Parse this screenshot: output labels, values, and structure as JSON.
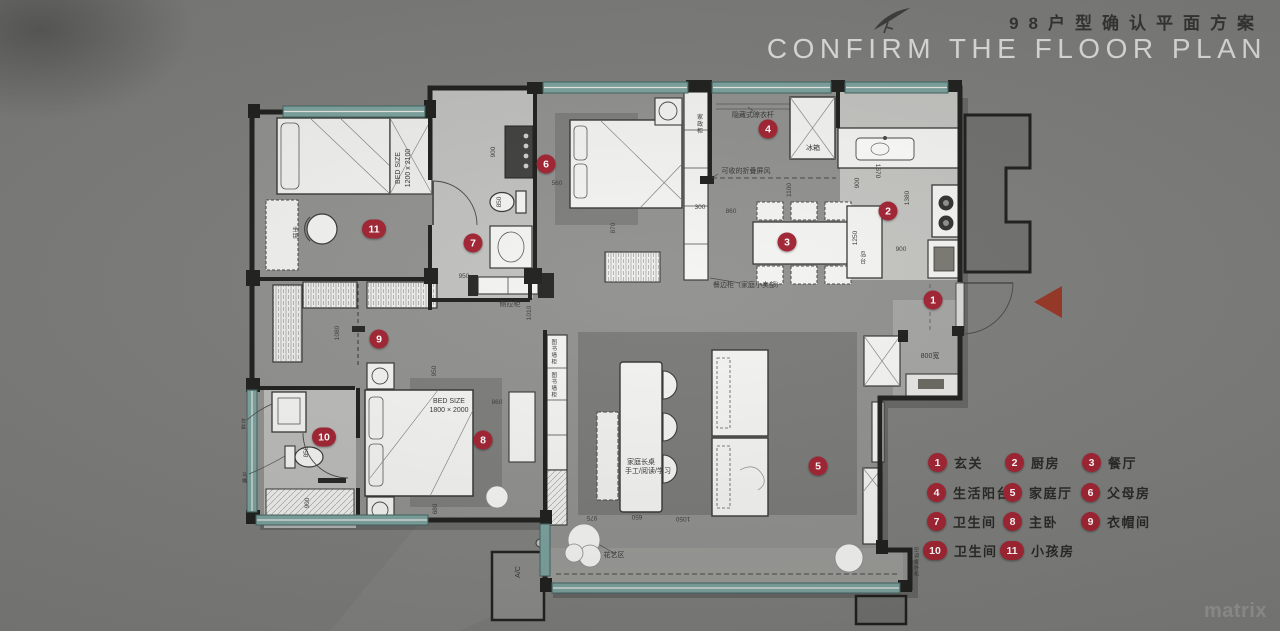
{
  "header": {
    "title_cn": "98户型确认平面方案",
    "title_en": "CONFIRM THE FLOOR PLAN"
  },
  "watermark": "matrix",
  "colors": {
    "background": "#7b7b79",
    "floor": "#8f8f8d",
    "wall": "#1b1b19",
    "window_teal": "#7aa19c",
    "badge_red": "#a01f2e",
    "entry_arrow_red": "#953120",
    "title_cn": "#30302c",
    "title_en": "#dededc"
  },
  "legend": {
    "items": [
      {
        "n": "1",
        "label": "玄关",
        "x": 928,
        "y": 453
      },
      {
        "n": "2",
        "label": "厨房",
        "x": 1005,
        "y": 453
      },
      {
        "n": "3",
        "label": "餐厅",
        "x": 1082,
        "y": 453
      },
      {
        "n": "4",
        "label": "生活阳台",
        "x": 927,
        "y": 483
      },
      {
        "n": "5",
        "label": "家庭厅",
        "x": 1003,
        "y": 483
      },
      {
        "n": "6",
        "label": "父母房",
        "x": 1081,
        "y": 483
      },
      {
        "n": "7",
        "label": "卫生间",
        "x": 927,
        "y": 512
      },
      {
        "n": "8",
        "label": "主卧",
        "x": 1003,
        "y": 512
      },
      {
        "n": "9",
        "label": "衣帽间",
        "x": 1081,
        "y": 512
      },
      {
        "n": "10",
        "label": "卫生间",
        "x": 923,
        "y": 541
      },
      {
        "n": "11",
        "label": "小孩房",
        "x": 1000,
        "y": 541
      }
    ]
  },
  "plan": {
    "badges": [
      {
        "n": "1",
        "x": 933,
        "y": 300
      },
      {
        "n": "2",
        "x": 888,
        "y": 211
      },
      {
        "n": "3",
        "x": 787,
        "y": 242
      },
      {
        "n": "4",
        "x": 768,
        "y": 129
      },
      {
        "n": "5",
        "x": 818,
        "y": 466
      },
      {
        "n": "6",
        "x": 546,
        "y": 164
      },
      {
        "n": "7",
        "x": 473,
        "y": 243
      },
      {
        "n": "8",
        "x": 483,
        "y": 440
      },
      {
        "n": "9",
        "x": 379,
        "y": 339
      },
      {
        "n": "10",
        "x": 324,
        "y": 437,
        "wide": 1
      },
      {
        "n": "11",
        "x": 374,
        "y": 229,
        "wide": 1
      }
    ],
    "annotations": [
      {
        "t": "BED SIZE",
        "x": 399,
        "y": 168,
        "r": -90
      },
      {
        "t": "1200 x 2100",
        "x": 409,
        "y": 168,
        "r": -90
      },
      {
        "t": "BED SIZE",
        "x": 449,
        "y": 402
      },
      {
        "t": "1800 × 2000",
        "x": 449,
        "y": 411
      },
      {
        "t": "家政柜",
        "x": 698,
        "y": 124,
        "v": 1,
        "s": 6
      },
      {
        "t": "隐藏式晾衣杆",
        "x": 753,
        "y": 116
      },
      {
        "t": "可收的折叠屏风",
        "x": 746,
        "y": 172
      },
      {
        "t": "餐边柜（家庭小卖部）",
        "x": 748,
        "y": 286
      },
      {
        "t": "冰箱",
        "x": 813,
        "y": 149
      },
      {
        "t": "岛台",
        "x": 861,
        "y": 258,
        "v": 1,
        "s": 6
      },
      {
        "t": "图书墙柜",
        "x": 553,
        "y": 352,
        "v": 1,
        "s": 5.5
      },
      {
        "t": "图书墙柜",
        "x": 553,
        "y": 385,
        "v": 1,
        "s": 5.5
      },
      {
        "t": "家庭长桌",
        "x": 641,
        "y": 463
      },
      {
        "t": "手工/阅读/学习",
        "x": 648,
        "y": 472
      },
      {
        "t": "花艺区",
        "x": 614,
        "y": 556
      },
      {
        "t": "A/C",
        "x": 519,
        "y": 572,
        "r": -90
      },
      {
        "t": "侧拉柜",
        "x": 510,
        "y": 305
      },
      {
        "t": "800宽",
        "x": 930,
        "y": 357
      },
      {
        "t": "坐镜",
        "x": 294,
        "y": 233,
        "v": 1,
        "s": 5.5
      },
      {
        "t": "空调室外机",
        "x": 916,
        "y": 562,
        "v": 1,
        "s": 5
      },
      {
        "t": "台盆",
        "x": 243,
        "y": 424,
        "v": 1,
        "s": 5
      },
      {
        "t": "马桶",
        "x": 244,
        "y": 478,
        "v": 1,
        "s": 5
      }
    ],
    "dimensions": [
      {
        "t": "900",
        "x": 494,
        "y": 152,
        "r": -90
      },
      {
        "t": "850",
        "x": 500,
        "y": 202,
        "r": -90
      },
      {
        "t": "950",
        "x": 464,
        "y": 277
      },
      {
        "t": "560",
        "x": 557,
        "y": 184
      },
      {
        "t": "870",
        "x": 614,
        "y": 228,
        "r": -90
      },
      {
        "t": "300",
        "x": 700,
        "y": 208
      },
      {
        "t": "860",
        "x": 731,
        "y": 212
      },
      {
        "t": "1100",
        "x": 790,
        "y": 190,
        "r": -90
      },
      {
        "t": "900",
        "x": 858,
        "y": 183,
        "r": -90
      },
      {
        "t": "1670",
        "x": 877,
        "y": 171,
        "r": 90
      },
      {
        "t": "1380",
        "x": 908,
        "y": 198,
        "r": -90
      },
      {
        "t": "1250",
        "x": 856,
        "y": 238,
        "r": -90
      },
      {
        "t": "900",
        "x": 901,
        "y": 250
      },
      {
        "t": "1080",
        "x": 338,
        "y": 333,
        "r": -90
      },
      {
        "t": "950",
        "x": 435,
        "y": 371,
        "r": -90
      },
      {
        "t": "860",
        "x": 497,
        "y": 403
      },
      {
        "t": "680",
        "x": 436,
        "y": 509,
        "r": -90
      },
      {
        "t": "850",
        "x": 307,
        "y": 452,
        "r": -90
      },
      {
        "t": "900",
        "x": 308,
        "y": 503,
        "r": -90
      },
      {
        "t": "975",
        "x": 592,
        "y": 517,
        "r": 180
      },
      {
        "t": "650",
        "x": 637,
        "y": 516,
        "r": 180
      },
      {
        "t": "1050",
        "x": 683,
        "y": 518,
        "r": 180
      },
      {
        "t": "1010",
        "x": 530,
        "y": 313,
        "r": -90
      }
    ]
  }
}
